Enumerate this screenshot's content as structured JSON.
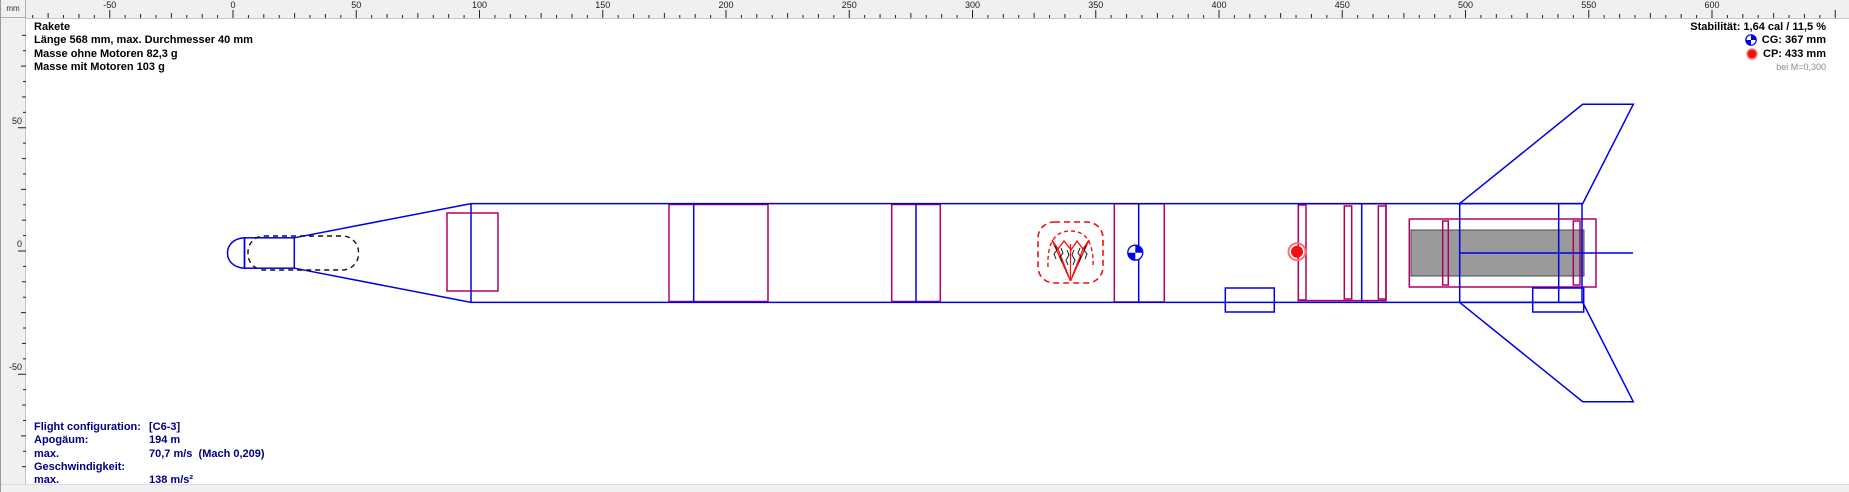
{
  "colors": {
    "blue": "#0000e8",
    "magenta": "#b00062",
    "red": "#ee1111",
    "motor-gray": "#9a9a9a",
    "navy": "#000080",
    "ruler-bg": "#f0f0f0"
  },
  "ruler": {
    "unit": "mm",
    "h_labels": [
      "-50",
      "0",
      "50",
      "100",
      "150",
      "200",
      "250",
      "300",
      "350",
      "400",
      "450",
      "500",
      "550",
      "600"
    ],
    "v_labels": [
      "50",
      "0",
      "-50"
    ]
  },
  "info": {
    "name": "Rakete",
    "dimensions": "Länge 568 mm, max. Durchmesser 40 mm",
    "mass_without_motors": "Masse ohne Motoren 82,3 g",
    "mass_with_motors": "Masse mit Motoren 103 g"
  },
  "stability": {
    "text": "Stabilität: 1,64 cal / 11,5 %",
    "cg": "CG: 367 mm",
    "cp": "CP: 433 mm",
    "condition": "bei M=0,300"
  },
  "flight": {
    "rows": [
      {
        "label": "Flight configuration:",
        "value": "[C6-3]"
      },
      {
        "label": "Apogäum:",
        "value": "194 m"
      },
      {
        "label": "max. Geschwindigkeit:",
        "value": "70,7 m/s  (Mach 0,209)"
      },
      {
        "label": "max. Beschleunigung:",
        "value": "138 m/s²"
      }
    ]
  }
}
